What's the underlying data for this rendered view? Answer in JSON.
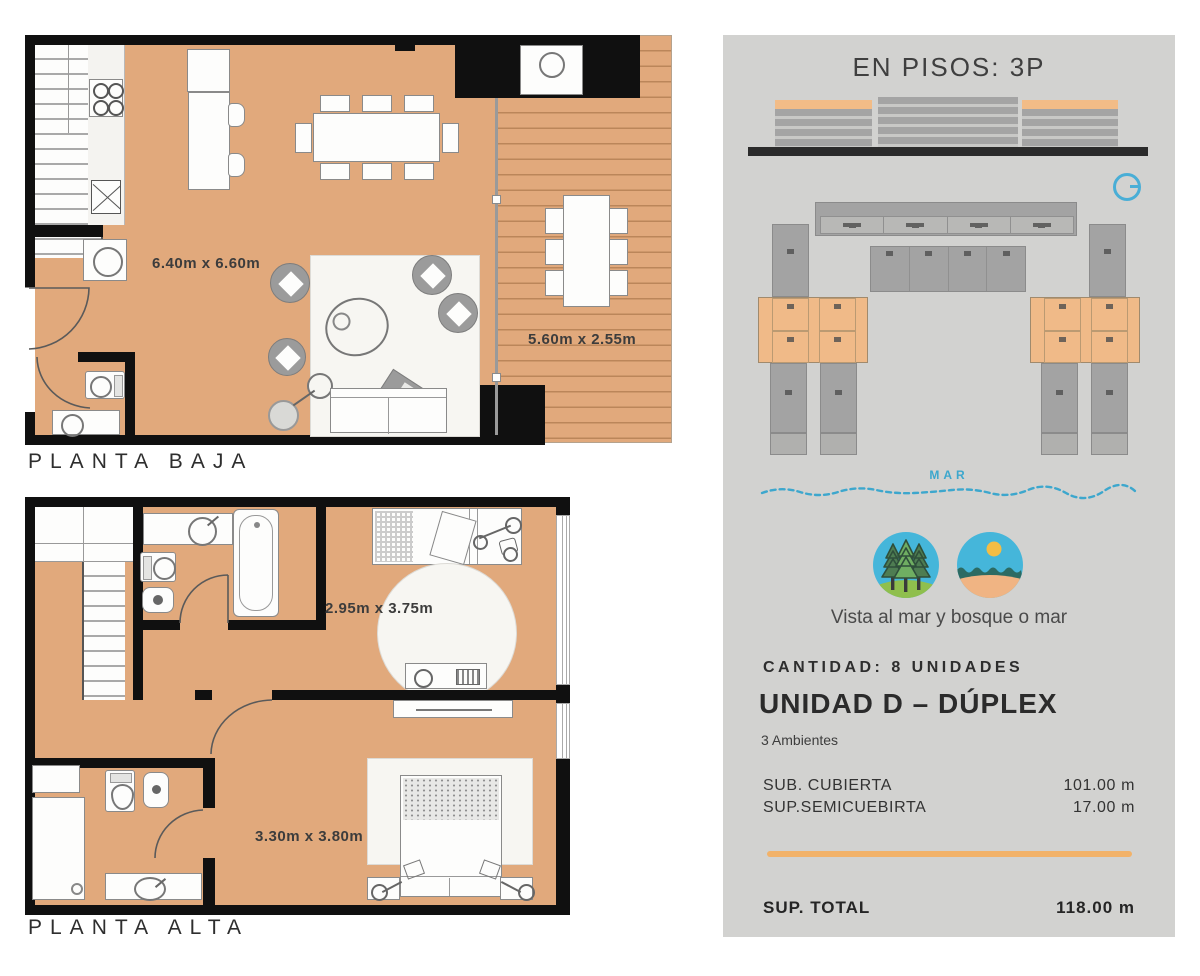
{
  "plans": {
    "baja": {
      "caption": "PLANTA BAJA",
      "living_dim": "6.40m x 6.60m",
      "deck_dim": "5.60m x 2.55m"
    },
    "alta": {
      "caption": "PLANTA ALTA",
      "bedroom2_dim": "2.95m x 3.75m",
      "bedroom1_dim": "3.30m x 3.80m"
    }
  },
  "panel": {
    "title": "EN PISOS: 3P",
    "sea_label": "MAR",
    "views_caption": "Vista al mar y bosque o mar",
    "quantity": "CANTIDAD: 8 UNIDADES",
    "unit_title": "UNIDAD D – DÚPLEX",
    "unit_subtitle": "3 Ambientes",
    "surfaces": [
      {
        "label": "SUB. CUBIERTA",
        "value": "101.00 m"
      },
      {
        "label": "SUP.SEMICUEBIRTA",
        "value": "17.00 m"
      }
    ],
    "total": {
      "label": "SUP. TOTAL",
      "value": "118.00 m"
    },
    "icons": {
      "forest": "forest-icon",
      "beach": "beach-icon",
      "north": "north-indicator-icon"
    },
    "colors": {
      "panel_bg": "#d2d2d0",
      "accent_orange": "#f2b269",
      "sea_blue": "#3da7cd",
      "floor_tan": "#e1a97c",
      "wall_black": "#101010"
    }
  }
}
